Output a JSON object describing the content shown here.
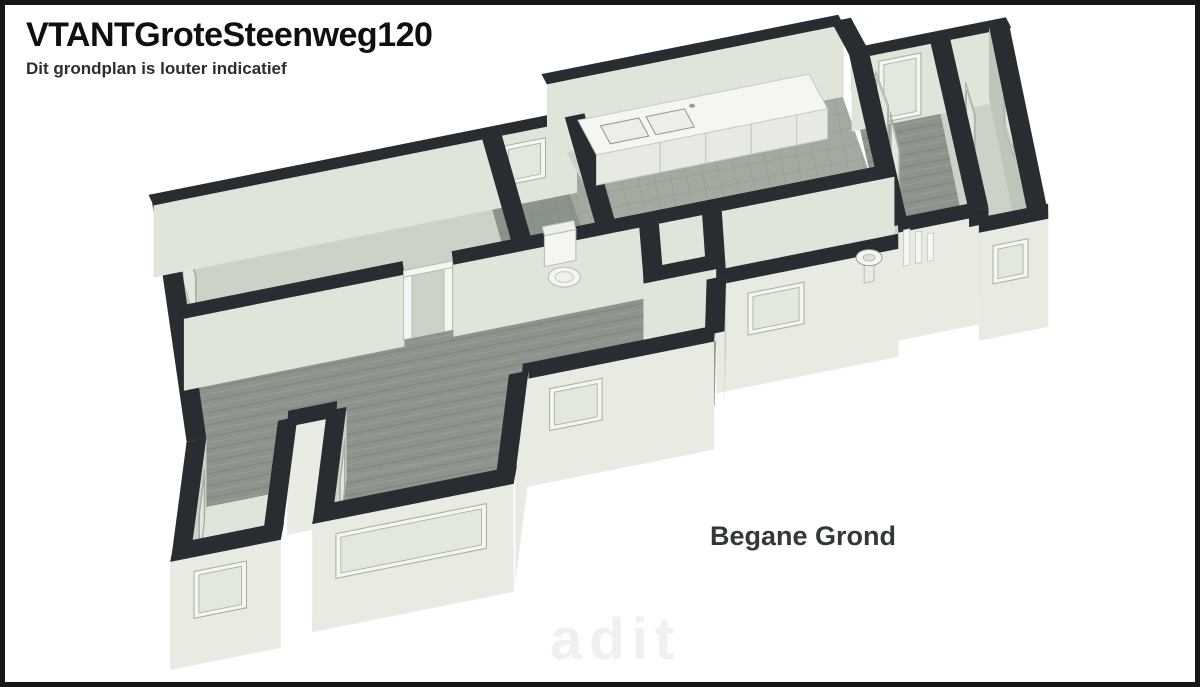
{
  "header": {
    "title": "VTANTGroteSteenweg120",
    "subtitle": "Dit grondplan is louter indicatief"
  },
  "plan_label": "Begane Grond",
  "watermark_text": "adit",
  "floorplan": {
    "palette": {
      "wall_top": "#272d30",
      "wall_lit": "#dfe5d8",
      "wall_mid": "#ccd4c7",
      "wall_shade": "#bcc6b9",
      "wall_ext": "#e8ebe2",
      "floor_wood": "#8e948b",
      "floor_wood_dark": "#838980",
      "floor_wood_light": "#999f95",
      "floor_tile": "#a3aba1",
      "floor_tile_line": "#939c92",
      "floor_tile_dark": "#8b948b",
      "floor_tile_dark_line": "#7e887f",
      "floor_sage": "#ccd3c6",
      "floor_bay": "#e0e5da",
      "fixture_white": "#f4f6f1",
      "fixture_face": "#e7eae2",
      "frame_line": "#a7ada3",
      "glass": "#e2e8dc"
    },
    "floors": [
      {
        "pts": [
          [
            -0.1,
            0.45
          ],
          [
            4.6,
            0.45
          ],
          [
            4.6,
            3.05
          ],
          [
            -0.1,
            3.05
          ]
        ],
        "fill": "floorSage"
      },
      {
        "pts": [
          [
            4.6,
            0.45
          ],
          [
            5.8,
            0.45
          ],
          [
            5.8,
            3.05
          ],
          [
            4.6,
            3.05
          ]
        ],
        "fill": "floorTileDark"
      },
      {
        "pts": [
          [
            5.8,
            -0.6
          ],
          [
            9.9,
            -0.6
          ],
          [
            9.9,
            3.05
          ],
          [
            5.8,
            3.05
          ]
        ],
        "fill": "floorTile"
      },
      {
        "pts": [
          [
            9.9,
            0.3
          ],
          [
            11.05,
            0.3
          ],
          [
            11.05,
            4.15
          ],
          [
            9.9,
            4.15
          ]
        ],
        "fill": "floorWood"
      },
      {
        "pts": [
          [
            11.05,
            0.3
          ],
          [
            11.9,
            0.3
          ],
          [
            11.9,
            4.45
          ],
          [
            11.05,
            4.45
          ]
        ],
        "fill": "floorSage"
      },
      {
        "pts": [
          [
            -0.1,
            3.05
          ],
          [
            6.4,
            3.05
          ],
          [
            6.4,
            5.45
          ],
          [
            -0.1,
            5.45
          ]
        ],
        "fill": "floorWood"
      },
      {
        "pts": [
          [
            6.4,
            3.05
          ],
          [
            7.3,
            3.05
          ],
          [
            7.3,
            4.15
          ],
          [
            6.4,
            4.15
          ]
        ],
        "fill": "floorSage"
      },
      {
        "pts": [
          [
            6.4,
            4.15
          ],
          [
            7.3,
            4.15
          ],
          [
            7.3,
            5.45
          ],
          [
            6.4,
            5.45
          ]
        ],
        "fill": "floorWood"
      },
      {
        "pts": [
          [
            7.3,
            3.05
          ],
          [
            9.9,
            3.05
          ],
          [
            9.9,
            4.45
          ],
          [
            7.3,
            4.45
          ]
        ],
        "fill": "floorSage"
      },
      {
        "pts": [
          [
            -0.1,
            5.45
          ],
          [
            1.2,
            5.45
          ],
          [
            1.2,
            7.3
          ],
          [
            -0.1,
            7.3
          ]
        ],
        "fill": "floorBay"
      },
      {
        "pts": [
          [
            1.9,
            5.45
          ],
          [
            4.5,
            5.45
          ],
          [
            4.5,
            7.15
          ],
          [
            1.9,
            7.15
          ]
        ],
        "fill": "floorWood"
      }
    ],
    "walls": [
      {
        "o": "v",
        "c": -0.1,
        "a": 0.45,
        "b": 5.5,
        "face": "e",
        "fc": "mid",
        "win": [
          {
            "a": 1.1,
            "b": 2.2,
            "z1": 0.15,
            "z2": 0.9
          }
        ]
      },
      {
        "o": "h",
        "c": 0.45,
        "a": -0.25,
        "b": 5.8,
        "face": "s",
        "fc": "lit",
        "win": [
          {
            "a": 4.75,
            "b": 5.35,
            "z1": 0.3,
            "z2": 0.85
          }
        ]
      },
      {
        "o": "v",
        "c": 5.8,
        "a": -0.6,
        "b": 0.45,
        "face": "e",
        "fc": "mid"
      },
      {
        "o": "h",
        "c": -0.6,
        "a": 5.66,
        "b": 9.9,
        "face": "s",
        "fc": "lit"
      },
      {
        "o": "v",
        "c": 9.9,
        "a": -0.6,
        "b": 0.3,
        "face": "e",
        "fc": "mid"
      },
      {
        "o": "h",
        "c": 0.3,
        "a": 9.76,
        "b": 12.04,
        "face": "s",
        "fc": "lit",
        "win": [
          {
            "a": 10.15,
            "b": 10.75,
            "z1": 0.04,
            "z2": 0.9
          }
        ]
      },
      {
        "o": "v",
        "c": 4.6,
        "a": 0.45,
        "b": 3.05,
        "face": "e",
        "fc": "mid"
      },
      {
        "o": "v",
        "c": 5.8,
        "a": 0.45,
        "b": 3.05,
        "face": "e",
        "fc": "mid"
      },
      {
        "o": "v",
        "c": 9.9,
        "a": 0.3,
        "b": 4.15,
        "face": "e",
        "fc": "mid",
        "win": [
          {
            "a": 0.7,
            "b": 1.55,
            "z1": 0.05,
            "z2": 0.92
          },
          {
            "a": 1.7,
            "b": 2.55,
            "z1": 0.05,
            "z2": 0.92
          }
        ]
      },
      {
        "o": "v",
        "c": 11.05,
        "a": 0.3,
        "b": 4.15,
        "face": "e",
        "fc": "mid",
        "win": [
          {
            "a": 1.3,
            "b": 2.05,
            "z1": 0.05,
            "z2": 0.88
          }
        ]
      },
      {
        "o": "v",
        "c": 11.9,
        "a": 0.3,
        "b": 4.5,
        "face": "w",
        "fc": "shade",
        "win": [
          {
            "a": 1.2,
            "b": 1.95,
            "z1": 0.12,
            "z2": 0.82
          }
        ]
      },
      {
        "o": "h",
        "c": 3.05,
        "a": -0.25,
        "b": 2.9,
        "face": "s",
        "fc": "lit"
      },
      {
        "o": "h",
        "c": 3.05,
        "a": 3.6,
        "b": 9.9,
        "face": "s",
        "fc": "lit"
      },
      {
        "o": "v",
        "c": 6.4,
        "a": 3.05,
        "b": 4.15,
        "face": "e",
        "fc": "mid"
      },
      {
        "o": "v",
        "c": 7.3,
        "a": 3.05,
        "b": 4.45,
        "face": "e",
        "fc": "mid"
      },
      {
        "o": "h",
        "c": 4.15,
        "a": 6.26,
        "b": 7.3,
        "face": "s",
        "fc": "lit"
      },
      {
        "o": "h",
        "c": 4.45,
        "a": 7.3,
        "b": 9.9,
        "face": "s",
        "fc": "ext",
        "ext": true,
        "win": [
          {
            "a": 7.75,
            "b": 8.55,
            "z1": 0.22,
            "z2": 0.8
          }
        ]
      },
      {
        "o": "v",
        "c": 7.3,
        "a": 4.45,
        "b": 5.45,
        "face": "e",
        "fc": "mid"
      },
      {
        "o": "h",
        "c": 4.15,
        "a": 9.9,
        "b": 11.05,
        "face": "s",
        "fc": "ext",
        "ext": true
      },
      {
        "o": "v",
        "c": 11.05,
        "a": 4.15,
        "b": 4.45,
        "face": "e",
        "fc": "ext",
        "ext": true
      },
      {
        "o": "h",
        "c": 4.45,
        "a": 11.05,
        "b": 12.04,
        "face": "s",
        "fc": "ext",
        "ext": true,
        "win": [
          {
            "a": 11.25,
            "b": 11.75,
            "z1": 0.25,
            "z2": 0.78
          }
        ]
      },
      {
        "o": "h",
        "c": 5.45,
        "a": 1.2,
        "b": 1.9,
        "face": "s",
        "fc": "ext",
        "ext": true
      },
      {
        "o": "h",
        "c": 5.45,
        "a": 4.55,
        "b": 7.3,
        "face": "s",
        "fc": "ext",
        "ext": true,
        "win": [
          {
            "a": 4.95,
            "b": 5.7,
            "z1": 0.22,
            "z2": 0.8
          }
        ]
      },
      {
        "o": "v",
        "c": -0.1,
        "a": 5.5,
        "b": 7.3,
        "face": "e",
        "fc": "mid",
        "win": [
          {
            "a": 5.85,
            "b": 6.6,
            "z1": 0.12,
            "z2": 0.85
          }
        ]
      },
      {
        "o": "v",
        "c": 1.2,
        "a": 5.45,
        "b": 7.3,
        "face": "w",
        "fc": "ext",
        "ext": true
      },
      {
        "o": "h",
        "c": 7.3,
        "a": -0.24,
        "b": 1.34,
        "face": "s",
        "fc": "ext",
        "ext": true,
        "win": [
          {
            "a": 0.1,
            "b": 0.85,
            "z1": 0.15,
            "z2": 0.8
          }
        ]
      },
      {
        "o": "v",
        "c": 1.9,
        "a": 5.45,
        "b": 7.15,
        "face": "e",
        "fc": "mid",
        "win": [
          {
            "a": 5.8,
            "b": 6.5,
            "z1": 0.15,
            "z2": 0.85
          }
        ]
      },
      {
        "o": "v",
        "c": 4.5,
        "a": 5.45,
        "b": 7.15,
        "face": "e",
        "fc": "ext",
        "ext": true
      },
      {
        "o": "h",
        "c": 7.15,
        "a": 1.76,
        "b": 4.64,
        "face": "s",
        "fc": "ext",
        "ext": true,
        "win": [
          {
            "a": 2.1,
            "b": 4.25,
            "z1": 0.18,
            "z2": 0.8
          }
        ]
      }
    ],
    "furniture": {
      "counter": {
        "x1": 6.1,
        "x2": 9.4,
        "y1": -0.45,
        "y2": 0.5,
        "h": 0.42,
        "seams": [
          7.0,
          7.65,
          8.3,
          8.95
        ],
        "sinks": [
          [
            6.35,
            6.9
          ],
          [
            7.0,
            7.55
          ]
        ],
        "sink_y1": -0.2,
        "sink_y2": 0.3
      },
      "toilet": {
        "x": 5.0,
        "y": 2.1
      },
      "basin": {
        "x": 9.5,
        "y": 3.75
      },
      "radiator": {
        "x": 10.0,
        "y": 3.6,
        "slats": 3
      },
      "doorframe": {
        "x1": 2.9,
        "x2": 3.6,
        "y": 3.05
      }
    }
  }
}
